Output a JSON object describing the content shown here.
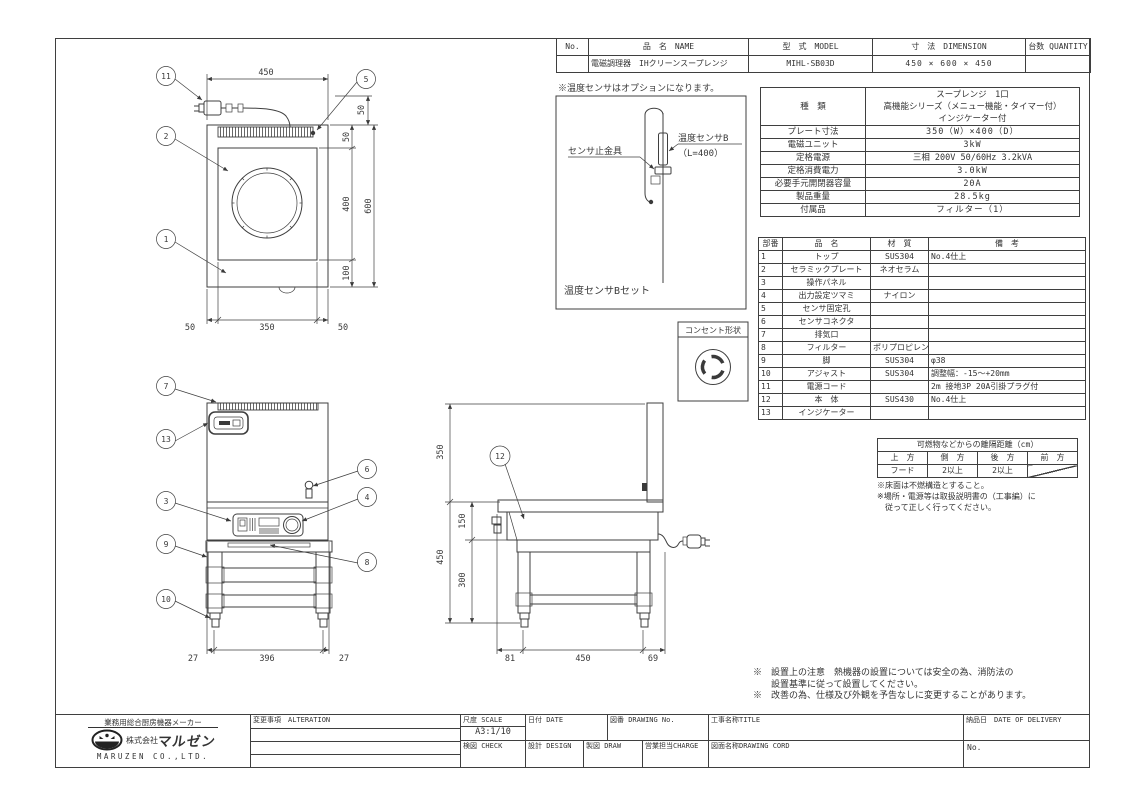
{
  "header_table": {
    "cols": {
      "no": "No.",
      "name": "品　名　NAME",
      "model": "型　式　MODEL",
      "dimension": "寸　法　DIMENSION",
      "quantity": "台数 QUANTITY"
    },
    "row": {
      "no": "",
      "name": "電磁調理器　IHクリーンスープレンジ",
      "model": "MIHL-SB03D",
      "dimension": "450 × 600 × 450",
      "quantity": ""
    }
  },
  "sensor_option": {
    "note": "※温度センサはオプションになります。",
    "clamp_label": "センサ止金具",
    "sensor_label": "温度センサB",
    "sensor_length": "（L=400）",
    "caption": "温度センサBセット"
  },
  "outlet": {
    "label": "コンセント形状"
  },
  "spec_table": {
    "rows": [
      {
        "label": "種　類",
        "value": "スープレンジ　1口\n高機能シリーズ（メニュー機能・タイマー付）\nインジケーター付"
      },
      {
        "label": "プレート寸法",
        "value": "350（W）×400（D）"
      },
      {
        "label": "電磁ユニット",
        "value": "3kW"
      },
      {
        "label": "定格電源",
        "value": "三相 200V 50/60Hz 3.2kVA"
      },
      {
        "label": "定格消費電力",
        "value": "3.0kW"
      },
      {
        "label": "必要手元開閉器容量",
        "value": "20A"
      },
      {
        "label": "製品重量",
        "value": "28.5kg"
      },
      {
        "label": "付属品",
        "value": "フィルター（1）"
      }
    ]
  },
  "parts_table": {
    "cols": {
      "no": "部番",
      "name": "品　名",
      "material": "材　質",
      "note": "備　考"
    },
    "rows": [
      {
        "no": "1",
        "name": "トップ",
        "material": "SUS304",
        "note": "No.4仕上"
      },
      {
        "no": "2",
        "name": "セラミックプレート",
        "material": "ネオセラム",
        "note": ""
      },
      {
        "no": "3",
        "name": "操作パネル",
        "material": "",
        "note": ""
      },
      {
        "no": "4",
        "name": "出力設定ツマミ",
        "material": "ナイロン",
        "note": ""
      },
      {
        "no": "5",
        "name": "センサ固定孔",
        "material": "",
        "note": ""
      },
      {
        "no": "6",
        "name": "センサコネクタ",
        "material": "",
        "note": ""
      },
      {
        "no": "7",
        "name": "排気口",
        "material": "",
        "note": ""
      },
      {
        "no": "8",
        "name": "フィルター",
        "material": "ポリプロピレン",
        "note": ""
      },
      {
        "no": "9",
        "name": "脚",
        "material": "SUS304",
        "note": "φ38"
      },
      {
        "no": "10",
        "name": "アジャスト",
        "material": "SUS304",
        "note": "調整幅：-15～+20mm"
      },
      {
        "no": "11",
        "name": "電源コード",
        "material": "",
        "note": "2m 接地3P 20A引掛プラグ付"
      },
      {
        "no": "12",
        "name": "本　体",
        "material": "SUS430",
        "note": "No.4仕上"
      },
      {
        "no": "13",
        "name": "インジケーター",
        "material": "",
        "note": ""
      }
    ]
  },
  "clearance_table": {
    "title": "可燃物などからの離隔距離（cm）",
    "cols": [
      "上　方",
      "側　方",
      "後　方",
      "前　方"
    ],
    "row": [
      "フード",
      "2以上",
      "2以上"
    ],
    "notes": "※床面は不燃構造とすること。\n※場所・電源等は取扱説明書の（工事編）に\n　従って正しく行ってください。"
  },
  "footnotes": {
    "line1": "※　設置上の注意　熱機器の設置については安全の為、消防法の",
    "line2": "　　設置基準に従って設置してください。",
    "line3": "※　改善の為、仕様及び外観を予告なしに変更することがあります。"
  },
  "title_block": {
    "maker_tagline": "業務用総合厨房機器メーカー",
    "company_prefix": "株式会社",
    "company_brand": "マルゼン",
    "company_en": "MARUZEN CO.,LTD.",
    "alteration": "変更事項　ALTERATION",
    "scale_label": "尺度 SCALE",
    "scale_value": "A3:1/10",
    "date_label": "日付 DATE",
    "check_label": "検図 CHECK",
    "design_label": "設計 DESIGN",
    "draw_label": "製図 DRAW",
    "drawing_no_label": "図番 DRAWING No.",
    "charge_label": "営業担当CHARGE",
    "title_label": "工事名称TITLE",
    "drawing_cord_label": "図面名称DRAWING CORD",
    "delivery_label": "納品日　DATE OF DELIVERY",
    "no_label": "No."
  },
  "balloons": {
    "b1": "1",
    "b2": "2",
    "b3": "3",
    "b4": "4",
    "b5": "5",
    "b6": "6",
    "b7": "7",
    "b8": "8",
    "b9": "9",
    "b10": "10",
    "b11": "11",
    "b12": "12",
    "b13": "13"
  },
  "dims": {
    "plan_width": "450",
    "plan_cord": "50",
    "plan_louver": "50",
    "plan_plate_h": "400",
    "plan_bottom": "100",
    "plan_total_h": "600",
    "plan_left": "50",
    "plan_plate_w": "350",
    "plan_right": "50",
    "front_left": "27",
    "front_mid": "396",
    "front_right": "27",
    "side_top": "350",
    "side_body": "150",
    "side_lower": "450",
    "side_stand": "300",
    "side_front": "81",
    "side_depth": "450",
    "side_rear": "69"
  }
}
